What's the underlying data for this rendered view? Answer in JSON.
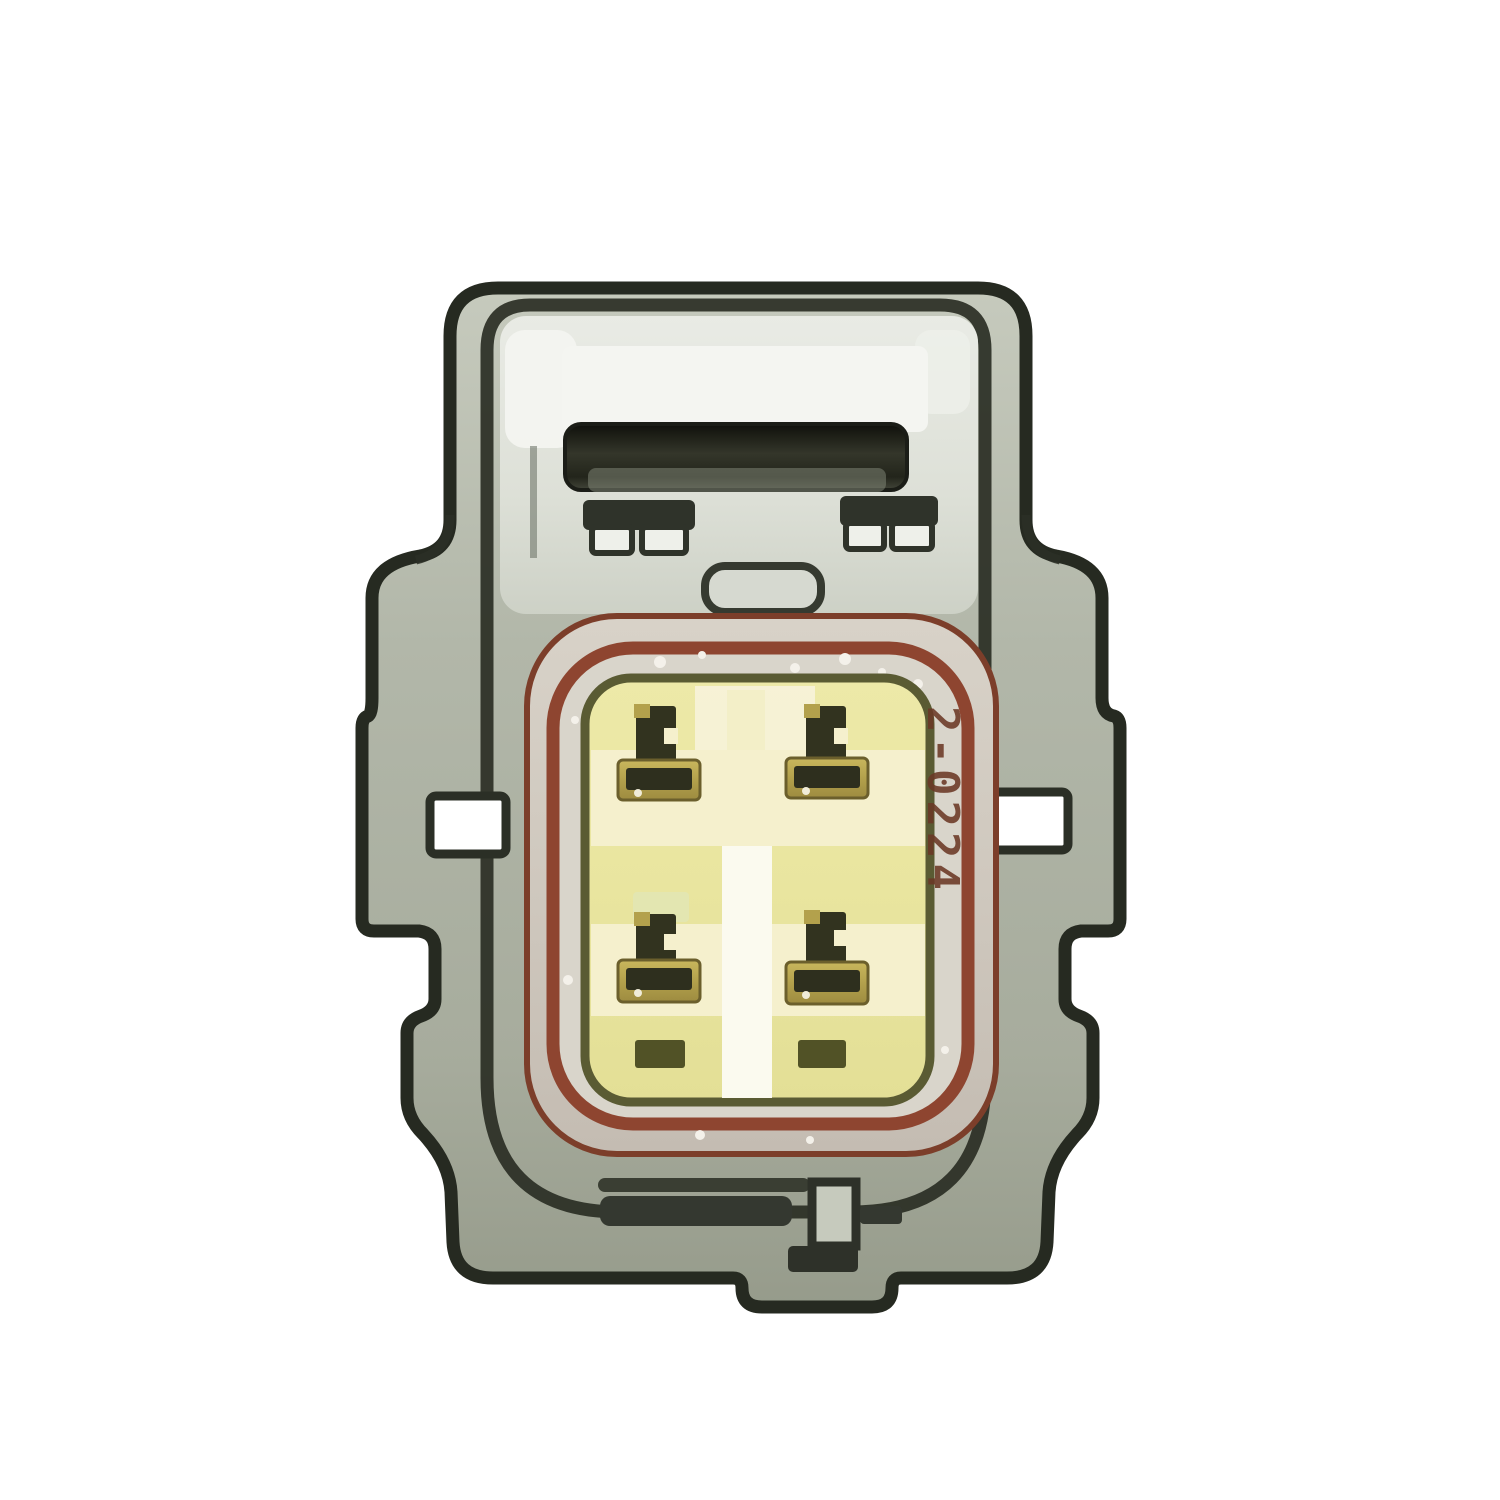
{
  "photo": {
    "background_color": "#ffffff",
    "subject": "Front face view of a gray 4-pin automotive electrical connector plug with yellow terminal insert and brown seal ring"
  },
  "connector": {
    "marking": "2-0224",
    "marking_color": "#6b3826",
    "pin_count": 4,
    "pin_positions": [
      "top-left",
      "top-right",
      "bottom-left",
      "bottom-right"
    ],
    "colors": {
      "housing_outline": "#262a21",
      "housing_metal": "#b2b7a9",
      "latch_bar": "#1d1f18",
      "seal_ring_brown": "#8e4530",
      "seal_silver": "#d2cbc1",
      "insert_yellow": "#eae6a0",
      "terminal_brass": "#b3a14c",
      "terminal_dark": "#32331f"
    }
  }
}
